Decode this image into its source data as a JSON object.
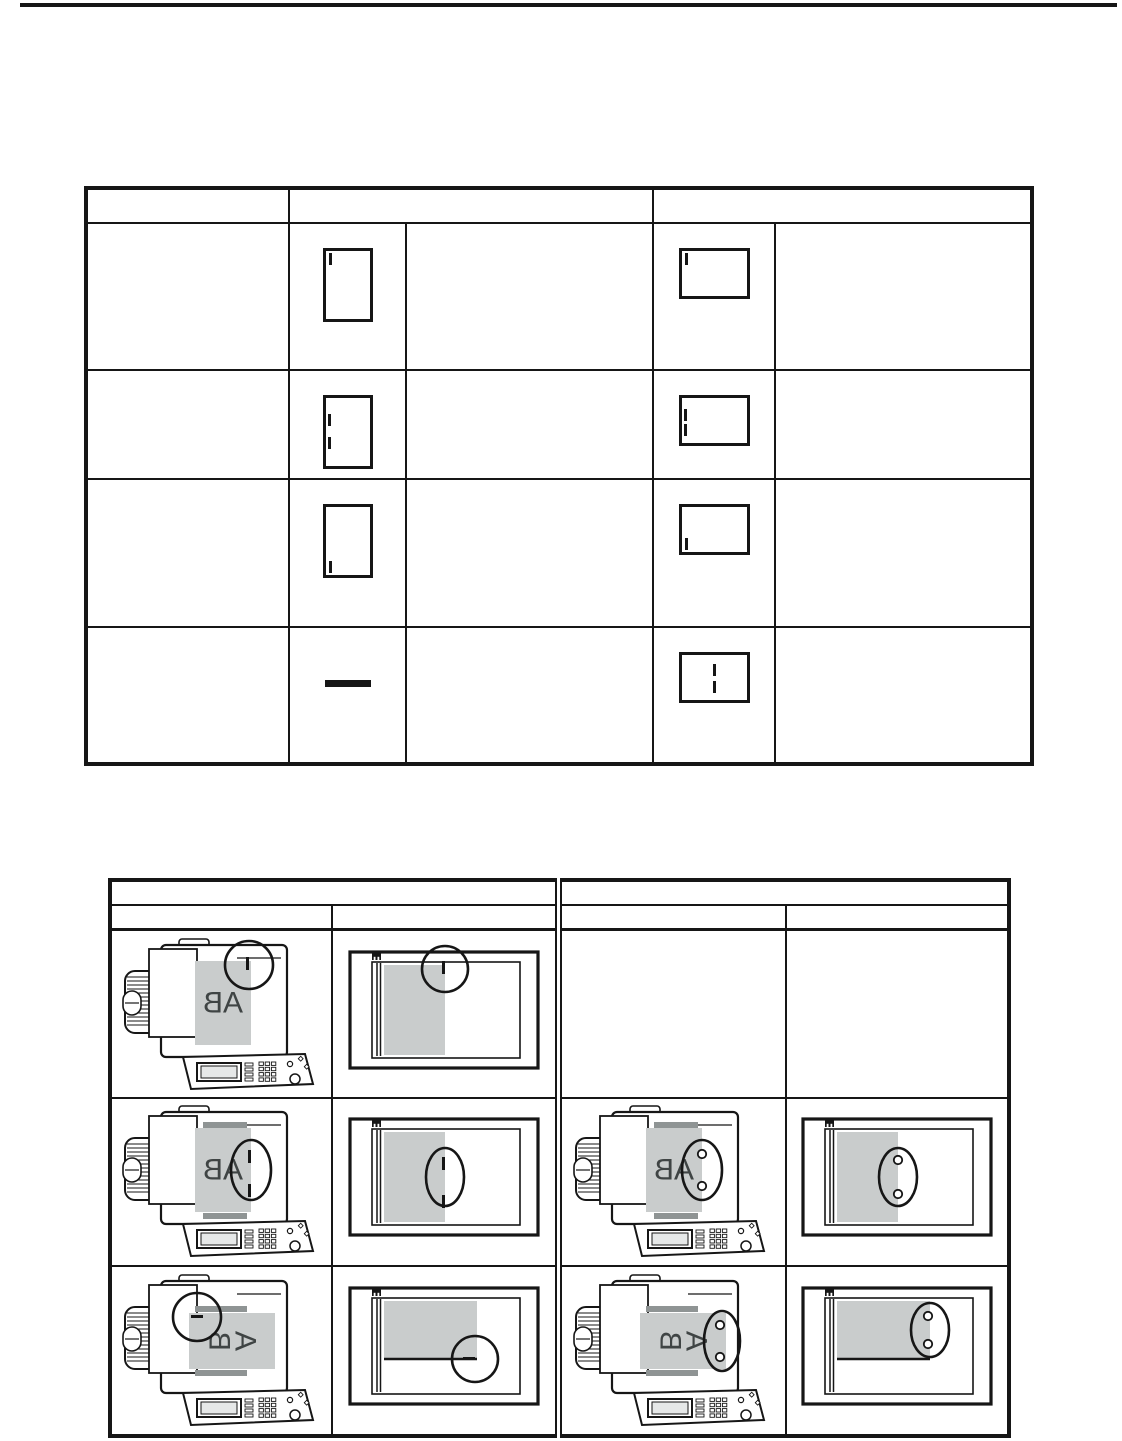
{
  "document_label": "AB",
  "colors": {
    "line": "#161616",
    "paper_gray": "#c9cccc",
    "label_text": "#3f4444",
    "screen_gray": "#e6e8e8",
    "clamp_gray": "#8f9494"
  },
  "staple_position_table": {
    "rows": [
      {
        "portrait_marks": [
          "top-left"
        ],
        "landscape_marks": [
          "top-left"
        ]
      },
      {
        "portrait_marks": [
          "left-upper",
          "left-lower"
        ],
        "landscape_marks": [
          "left-upper",
          "left-lower"
        ]
      },
      {
        "portrait_marks": [
          "bottom-left"
        ],
        "landscape_marks": [
          "bottom-left"
        ]
      },
      {
        "portrait_marks": "none",
        "landscape_marks": [
          "center-upper",
          "center-lower"
        ]
      }
    ]
  },
  "orientation_table": {
    "rows": [
      [
        {
          "type": "copier",
          "doc": "portrait",
          "highlight": "top-right",
          "mark": "staple-1",
          "clamps": false
        },
        {
          "type": "output",
          "doc": "portrait",
          "highlight": "top-right",
          "mark": "staple-1"
        },
        {
          "type": "empty"
        },
        {
          "type": "empty"
        }
      ],
      [
        {
          "type": "copier",
          "doc": "portrait",
          "highlight": "right-mid",
          "mark": "staple-2",
          "clamps": true
        },
        {
          "type": "output",
          "doc": "portrait",
          "highlight": "right-mid",
          "mark": "staple-2"
        },
        {
          "type": "copier",
          "doc": "portrait",
          "highlight": "right-mid",
          "mark": "punch-2",
          "clamps": true
        },
        {
          "type": "output",
          "doc": "portrait",
          "highlight": "right-mid",
          "mark": "punch-2"
        }
      ],
      [
        {
          "type": "copier",
          "doc": "landscape",
          "highlight": "top-left",
          "mark": "staple-1h",
          "clamps": true
        },
        {
          "type": "output",
          "doc": "landscape",
          "highlight": "bottom-right",
          "mark": "staple-1h"
        },
        {
          "type": "copier",
          "doc": "landscape",
          "highlight": "right-mid",
          "mark": "punch-2",
          "clamps": true
        },
        {
          "type": "output",
          "doc": "landscape",
          "highlight": "right-mid",
          "mark": "punch-2"
        }
      ]
    ]
  }
}
